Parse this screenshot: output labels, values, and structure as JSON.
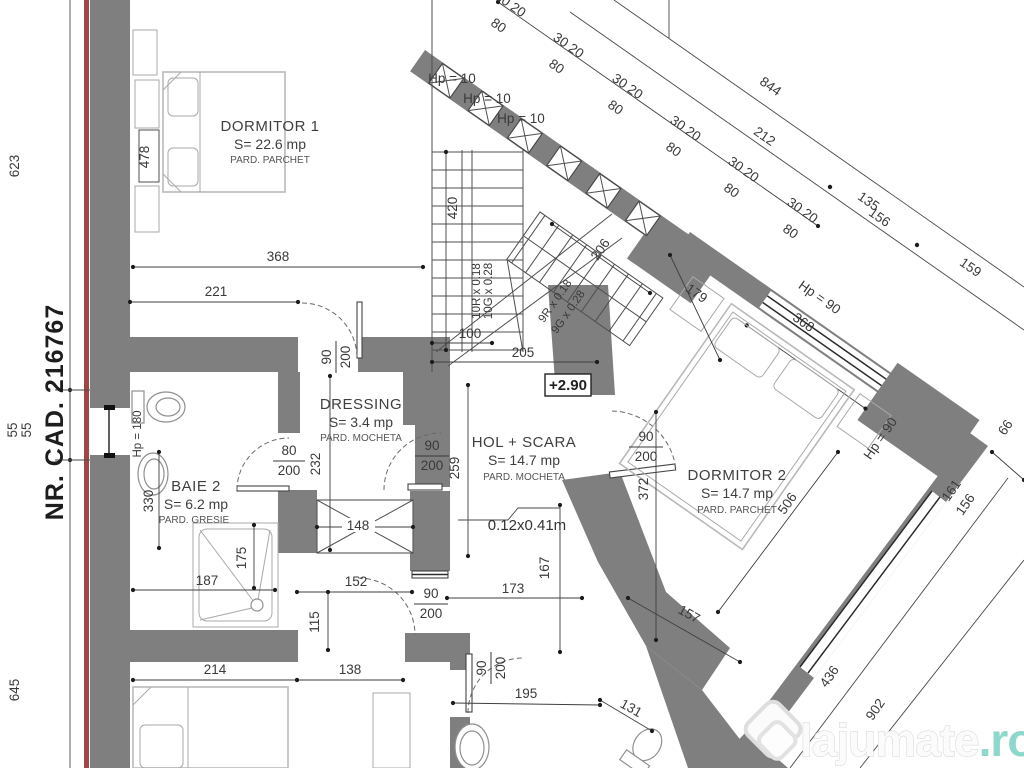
{
  "plan": {
    "cadastral_number": "NR. CAD. 216767",
    "level_marker": "+2.90",
    "step_note": "0.12x0.41m"
  },
  "rooms": {
    "dormitor1": {
      "name": "DORMITOR 1",
      "area": "S= 22.6 mp",
      "floor": "PARD. PARCHET"
    },
    "dressing": {
      "name": "DRESSING",
      "area": "S= 3.4 mp",
      "floor": "PARD. MOCHETA"
    },
    "baie2": {
      "name": "BAIE 2",
      "area": "S= 6.2 mp",
      "floor": "PARD. GRESIE"
    },
    "hol": {
      "name": "HOL + SCARA",
      "area": "S= 14.7 mp",
      "floor": "PARD. MOCHETA"
    },
    "dormitor2": {
      "name": "DORMITOR 2",
      "area": "S= 14.7 mp",
      "floor": "PARD. PARCHET"
    }
  },
  "stairs": {
    "flight1_risers": "10R x 0.18",
    "flight1_treads": "10G x 0.28",
    "flight2_risers": "9R x 0.18",
    "flight2_treads": "9G x 0.28"
  },
  "openings": {
    "hp10": "Hp = 10",
    "hp90": "Hp = 90",
    "hp180": "Hp = 180",
    "pattern_3020": "30 20",
    "pattern_80": "80"
  },
  "doors": {
    "w90": "90",
    "w80": "80",
    "h200": "200"
  },
  "dims": {
    "d623": "623",
    "d55a": "55",
    "d55b": "55",
    "d645": "645",
    "d478": "478",
    "d368": "368",
    "d221": "221",
    "d420": "420",
    "d100": "100",
    "d205": "205",
    "d206": "206",
    "d844": "844",
    "d212": "212",
    "d135": "135",
    "d156": "156",
    "d159": "159",
    "d179": "179",
    "d368b": "368",
    "d372": "372",
    "d506": "506",
    "d157": "157",
    "d161": "161",
    "d156b": "156",
    "d66": "66",
    "d436": "436",
    "d902": "902",
    "d232": "232",
    "d259": "259",
    "d148": "148",
    "d330": "330",
    "d187": "187",
    "d175": "175",
    "d152": "152",
    "d115": "115",
    "d173": "173",
    "d167": "167",
    "d214": "214",
    "d138": "138",
    "d195": "195",
    "d131": "131"
  },
  "watermark": {
    "brand": "lajumate",
    "tld": ".ro"
  },
  "colors": {
    "wall": "#7f7f7f",
    "boundary_red": "#a24644",
    "watermark_accent": "#8ed8cb",
    "paper": "#ffffff"
  }
}
